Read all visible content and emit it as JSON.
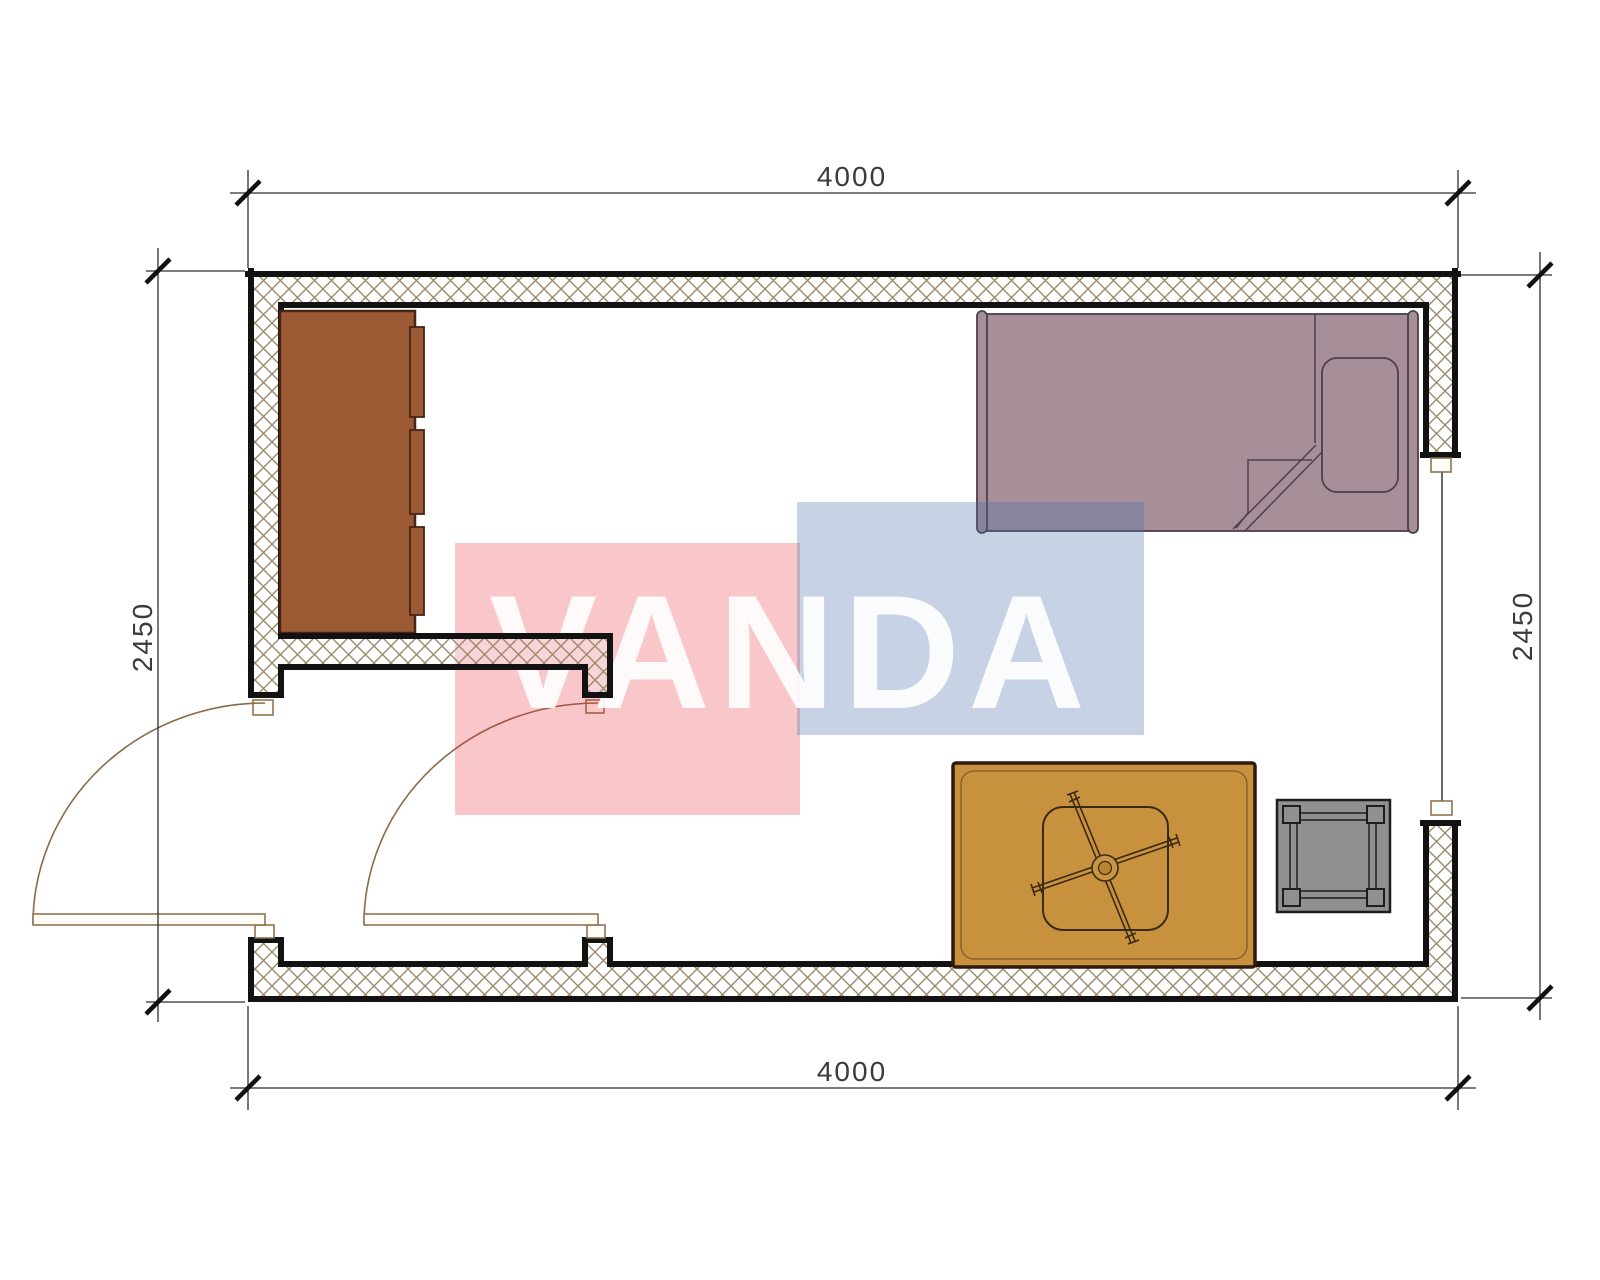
{
  "title": "Room floor plan 4000 x 2450",
  "dimensions": {
    "top": "4000",
    "bottom": "4000",
    "left": "2450",
    "right": "2450"
  },
  "watermark": {
    "text": "VANDA",
    "red_block_color": "rgba(233,30,45,0.25)",
    "blue_block_color": "rgba(70,110,170,0.30)",
    "letter_color": "rgba(255,255,255,0.90)"
  },
  "colors": {
    "wall_outline": "#121212",
    "hatch_line": "#9a8a69",
    "door_line": "#8a6a48",
    "window_line": "#3a4452",
    "wardrobe": "#9b5a33",
    "wardrobe_outline": "#462416",
    "bed": "#a78f9a",
    "bed_outline": "#4d4049",
    "table": "#c8913e",
    "table_outline": "#2e1d0d",
    "stool": "#909090",
    "stool_outline": "#1e1e1e",
    "dim_line": "#2f2f2f"
  },
  "furniture": [
    {
      "name": "wardrobe",
      "position": "top-left along left wall"
    },
    {
      "name": "single-bed",
      "position": "top-right along top wall"
    },
    {
      "name": "desk-with-office-chair",
      "position": "bottom-right on bottom wall"
    },
    {
      "name": "stool-table",
      "position": "bottom-right near window wall"
    }
  ],
  "openings": [
    {
      "name": "entry-door-left-wall",
      "swing": "outward-left"
    },
    {
      "name": "interior-door-partition",
      "swing": "into-vestibule"
    },
    {
      "name": "window-right-wall"
    }
  ]
}
